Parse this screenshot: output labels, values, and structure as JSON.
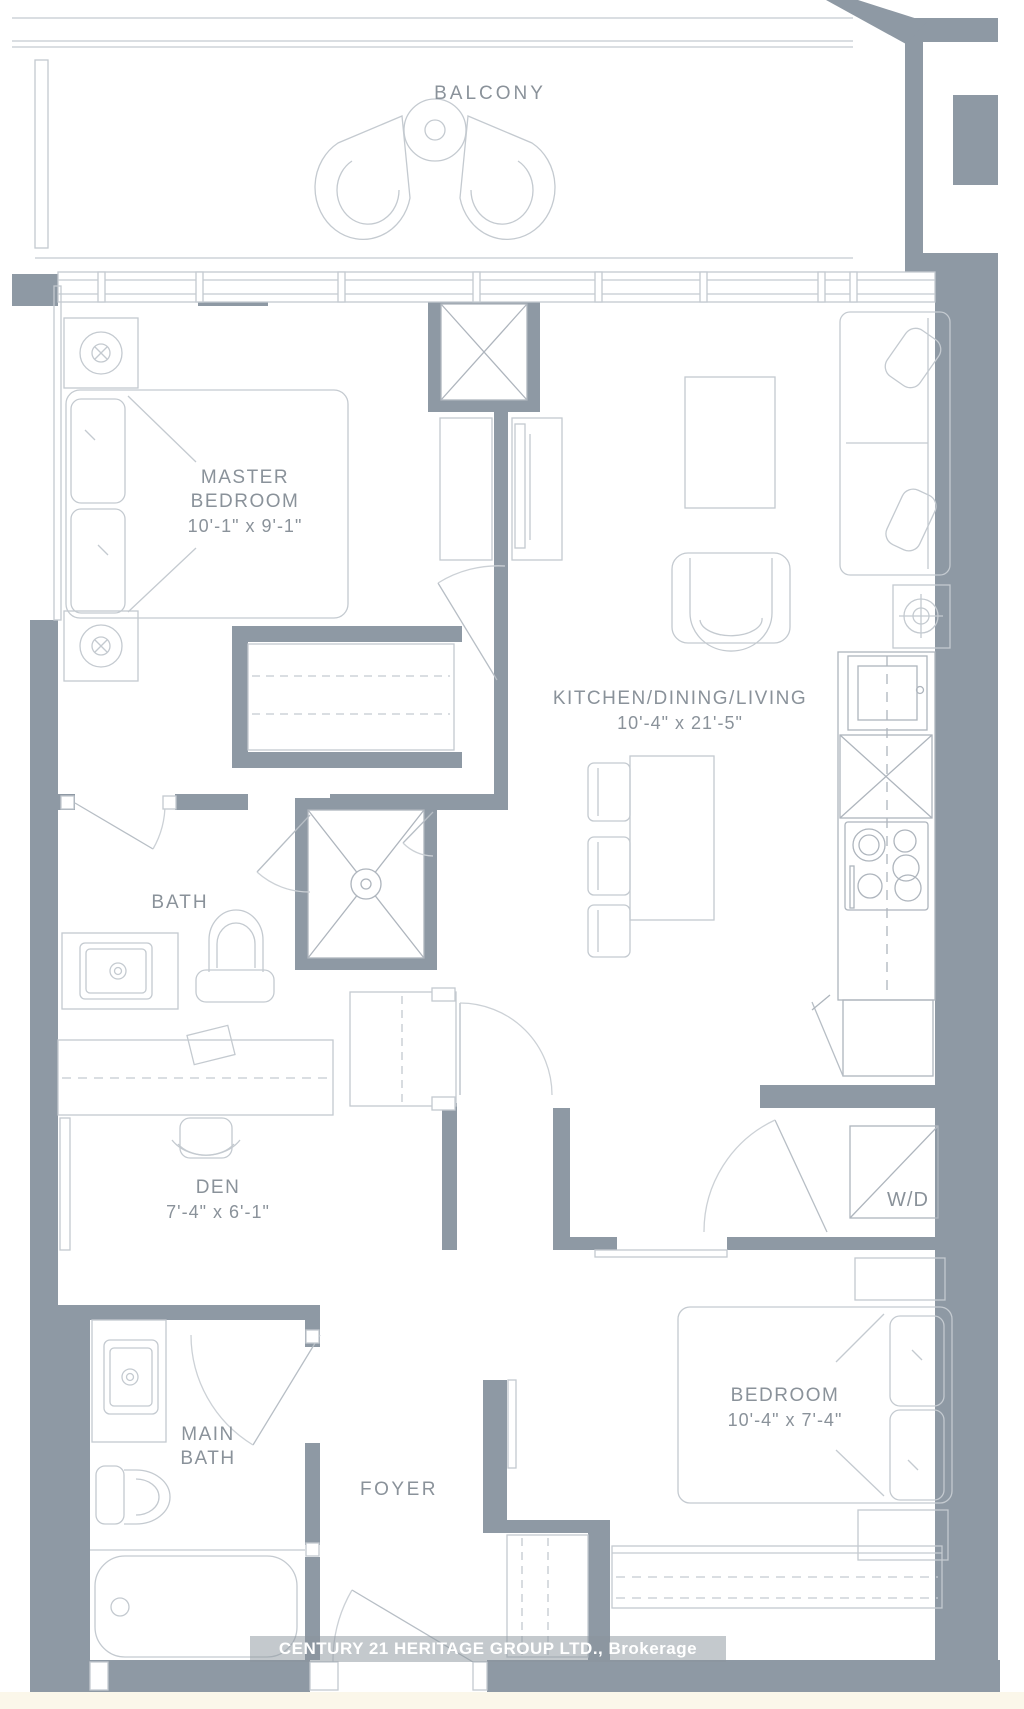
{
  "plan": {
    "watermark": "CENTURY 21 HERITAGE GROUP LTD., Brokerage",
    "rooms": {
      "balcony": {
        "label": "BALCONY"
      },
      "master_bedroom": {
        "line1": "MASTER",
        "line2": "BEDROOM",
        "dims": "10'-1\" x 9'-1\""
      },
      "kitchen_dining_living": {
        "line1": "KITCHEN/DINING/LIVING",
        "dims": "10'-4\" x 21'-5\""
      },
      "bath": {
        "label": "BATH"
      },
      "den": {
        "label": "DEN",
        "dims": "7'-4\" x 6'-1\""
      },
      "laundry": {
        "label": "W/D"
      },
      "main_bath": {
        "line1": "MAIN",
        "line2": "BATH"
      },
      "foyer": {
        "label": "FOYER"
      },
      "bedroom": {
        "label": "BEDROOM",
        "dims": "10'-4\" x 7'-4\""
      }
    },
    "fixtures": {
      "balcony": [
        "round-table",
        "lounge-chair",
        "lounge-chair"
      ],
      "master_bedroom": [
        "queen-bed",
        "pillows",
        "nightstand-lamp",
        "nightstand-lamp",
        "reach-in-closet",
        "window-wall"
      ],
      "kitchen_dining_living": [
        "sofa",
        "side-table-lamp",
        "coffee-table",
        "armchair",
        "tv-console",
        "dining-table",
        "dining-chairs",
        "oven",
        "fridge",
        "cooktop",
        "counter"
      ],
      "bath": [
        "vanity-sink",
        "toilet",
        "shower-stall"
      ],
      "den": [
        "desk",
        "desk-chair"
      ],
      "laundry": [
        "washer-dryer"
      ],
      "main_bath": [
        "vanity-sink",
        "toilet",
        "bathtub"
      ],
      "bedroom": [
        "double-bed",
        "pillows",
        "nightstand",
        "nightstand",
        "closet"
      ],
      "foyer": [
        "entry-door",
        "foyer-closet"
      ]
    },
    "colors": {
      "wall": "#8e99a4",
      "furniture_line": "#c4cad0",
      "appliance_line": "#aeb5bd",
      "label_text": "#8a929a",
      "watermark_text": "#ffffff",
      "watermark_band": "rgba(138,147,156,0.5)",
      "paper": "#ffffff",
      "margin_strip": "#fbf7ea"
    }
  }
}
